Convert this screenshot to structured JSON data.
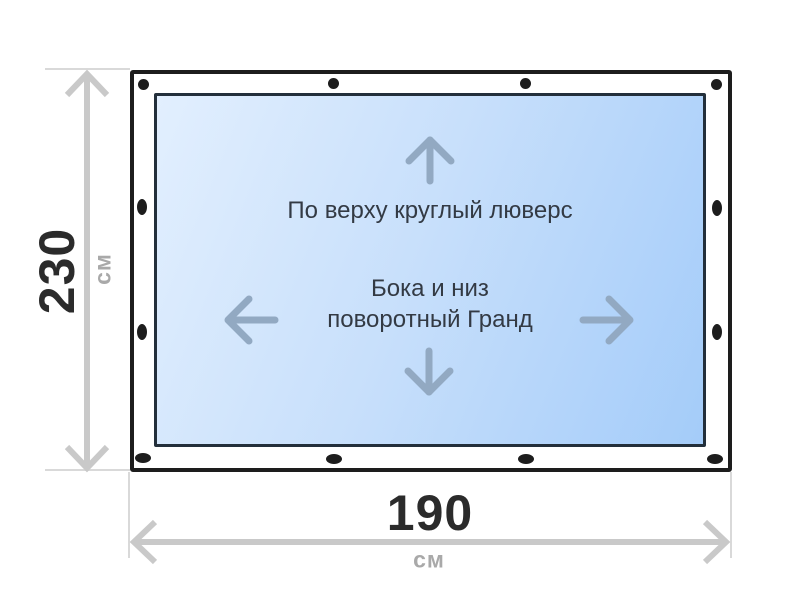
{
  "diagram": {
    "panel_notes": {
      "top": "По верху круглый люверс",
      "middle_line1": "Бока и низ",
      "middle_line2": "поворотный Гранд"
    },
    "dimensions": {
      "height": {
        "value": "230",
        "unit": "см"
      },
      "width": {
        "value": "190",
        "unit": "см"
      }
    },
    "grommets": {
      "top_count": 4,
      "bottom_count": 4,
      "left_count": 2,
      "right_count": 2,
      "shape": "round"
    },
    "icons": {
      "arrow_up": "arrow-up-icon",
      "arrow_down": "arrow-down-icon",
      "arrow_left": "arrow-left-icon",
      "arrow_right": "arrow-right-icon",
      "dim_vertical": "vertical-dimension-arrow",
      "dim_horizontal": "horizontal-dimension-arrow"
    },
    "colors": {
      "panel_gradient_start": "#e2effe",
      "panel_gradient_end": "#a4ccf9",
      "frame_border": "#1d1d1d",
      "panel_border": "#232f3b",
      "grommet": "#1d1d1d",
      "inner_arrow": "#92a9c2",
      "dimension_line": "#c9c9c9",
      "extension_line": "#d9d9d9",
      "dimension_value_text": "#2b2b2b",
      "dimension_unit_text": "#a9a9a9",
      "note_text": "#333a44"
    }
  }
}
